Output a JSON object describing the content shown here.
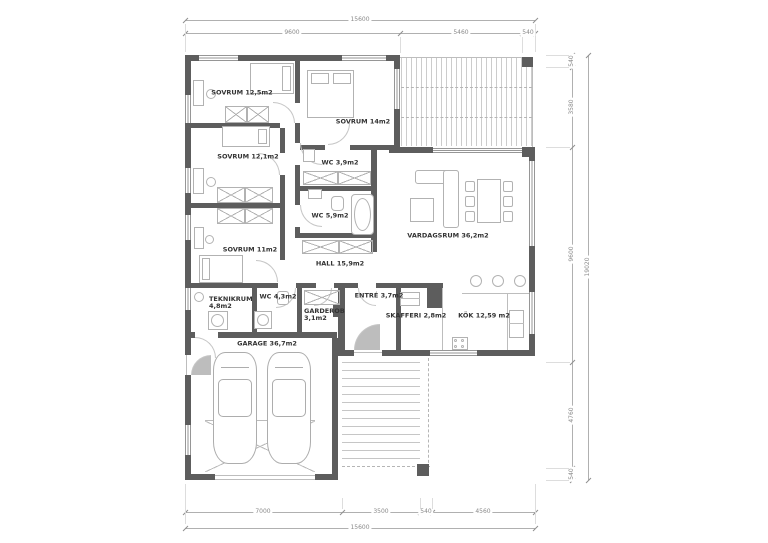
{
  "plan": {
    "rooms": [
      {
        "id": "sovrum-1",
        "label": "SOVRUM 12,5m2"
      },
      {
        "id": "sovrum-2",
        "label": "SOVRUM 14m2"
      },
      {
        "id": "sovrum-3",
        "label": "SOVRUM 12,1m2"
      },
      {
        "id": "wc-1",
        "label": "WC 3,9m2"
      },
      {
        "id": "wc-2",
        "label": "WC 5,9m2"
      },
      {
        "id": "sovrum-4",
        "label": "SOVRUM 11m2"
      },
      {
        "id": "hall",
        "label": "HALL 15,9m2"
      },
      {
        "id": "vardagsrum",
        "label": "VARDAGSRUM 36,2m2"
      },
      {
        "id": "teknikrum",
        "label": "TEKNIKRUM 4,8m2"
      },
      {
        "id": "wc-3",
        "label": "WC 4,3m2"
      },
      {
        "id": "garderob",
        "label": "GARDEROB 3,1m2"
      },
      {
        "id": "entre",
        "label": "ENTRÉ 3,7m2"
      },
      {
        "id": "skafferi",
        "label": "SKAFFERI 2,8m2"
      },
      {
        "id": "kok",
        "label": "KÖK 12,59 m2"
      },
      {
        "id": "garage",
        "label": "GARAGE 36,7m2"
      }
    ],
    "dimensions": {
      "top": {
        "total": "15600",
        "segments": [
          "9600",
          "5460",
          "540"
        ]
      },
      "right": {
        "total": "19020",
        "segments": [
          "540",
          "3580",
          "9600",
          "4760",
          "540"
        ]
      },
      "bottom": {
        "total": "15600",
        "segments": [
          "7000",
          "3500",
          "540",
          "4560"
        ]
      }
    },
    "colors": {
      "wall": "#5d5d5d",
      "furniture_line": "#b2b2b2",
      "dimension_line": "#b0b0b0",
      "dimension_text": "#8a8a8a",
      "label_text": "#333333"
    }
  }
}
